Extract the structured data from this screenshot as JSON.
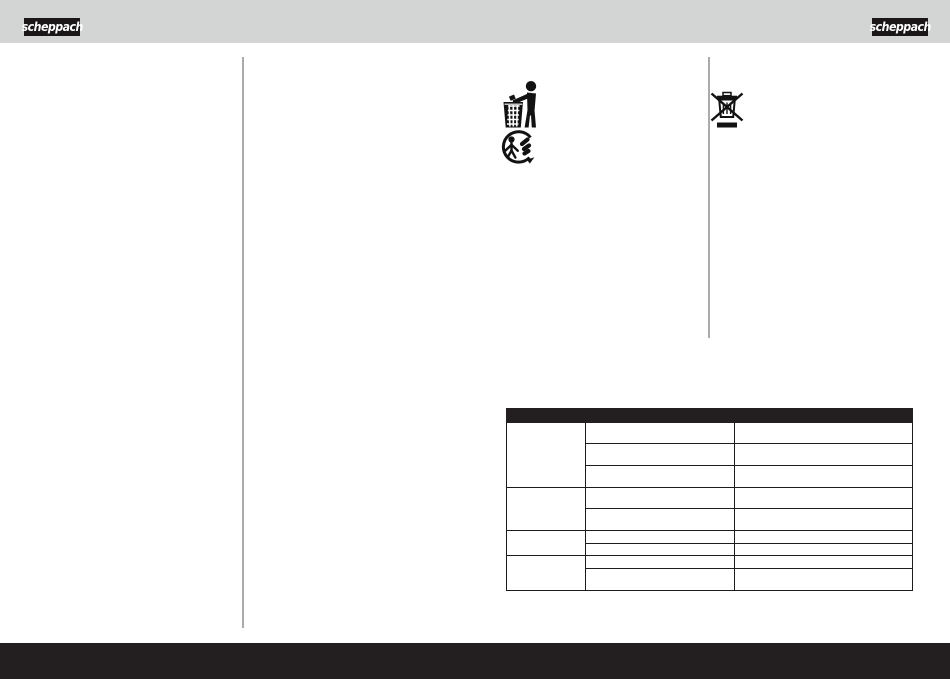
{
  "page": {
    "background": "#ffffff",
    "top_band_color": "#d3d4d4",
    "footer_bar_color": "#231f20",
    "divider_color": "#ababab"
  },
  "brand": {
    "logo_text": "scheppach",
    "logo_bg": "#1b1718",
    "logo_text_color": "#ffffff"
  },
  "icons": {
    "tidy_man": "tidy-man-dispose-in-bin-pictogram",
    "triman": "triman-recycling-pictogram",
    "weee": "crossed-out-wheelie-bin-pictogram"
  },
  "table": {
    "header_bg": "#231f20",
    "border_color": "#1c1c1c",
    "header_label": "",
    "columns": [
      "",
      "",
      ""
    ],
    "groups": [
      {
        "label": "",
        "rows": [
          [
            "",
            ""
          ],
          [
            "",
            ""
          ],
          [
            "",
            ""
          ]
        ]
      },
      {
        "label": "",
        "rows": [
          [
            "",
            ""
          ],
          [
            "",
            ""
          ]
        ]
      },
      {
        "label": "",
        "rows": [
          [
            "",
            ""
          ],
          [
            "",
            ""
          ]
        ]
      },
      {
        "label": "",
        "rows": [
          [
            "",
            ""
          ],
          [
            "",
            ""
          ]
        ]
      }
    ]
  }
}
